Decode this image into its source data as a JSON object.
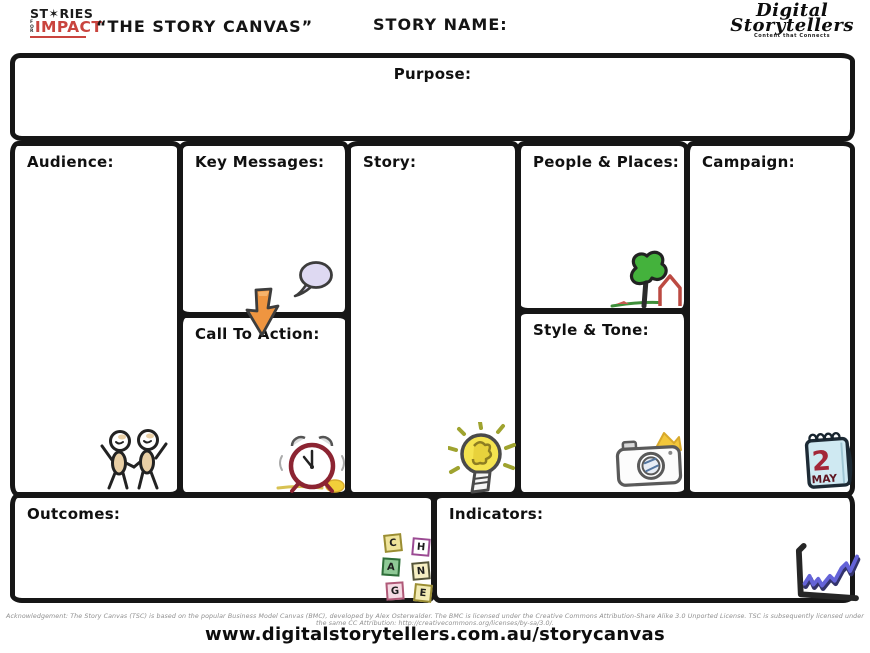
{
  "header": {
    "logo_stories": {
      "line1": "ST✶RIES",
      "for_text": "FOR",
      "line2": "IMPACT"
    },
    "canvas_title": "“THE STORY CANVAS”",
    "story_name_label": "STORY NAME:",
    "logo_digital": {
      "line1": "Digital",
      "line2": "Storytellers",
      "tagline": "Content that Connects"
    }
  },
  "sections": {
    "purpose": {
      "label": "Purpose:"
    },
    "audience": {
      "label": "Audience:"
    },
    "key_messages": {
      "label": "Key Messages:"
    },
    "call_to_action": {
      "label": "Call To Action:"
    },
    "story": {
      "label": "Story:"
    },
    "people_places": {
      "label": "People & Places:"
    },
    "style_tone": {
      "label": "Style & Tone:"
    },
    "campaign": {
      "label": "Campaign:"
    },
    "outcomes": {
      "label": "Outcomes:"
    },
    "indicators": {
      "label": "Indicators:"
    }
  },
  "icons": {
    "names": [
      "people-icon",
      "speech-bubble-icon",
      "down-arrow-icon",
      "tree-house-icon",
      "alarm-clock-icon",
      "lightbulb-icon",
      "camera-icon",
      "calendar-icon",
      "change-blocks-icon",
      "line-graph-icon"
    ],
    "calendar": {
      "day": "2",
      "month": "MAY"
    },
    "change_blocks": [
      "C",
      "H",
      "A",
      "N",
      "G",
      "E"
    ]
  },
  "footer": {
    "acknowledgement": "Acknowledgement: The Story Canvas (TSC) is based on the popular Business Model Canvas (BMC), developed by Alex Osterwalder. The BMC is licensed under the Creative Commons Attribution-Share Alike 3.0 Unported License. TSC is subsequently licensed under the same CC Attribution: http://creativecommons.org/licenses/by-sa/3.0/.",
    "url": "www.digitalstorytellers.com.au/storycanvas"
  },
  "colors": {
    "border_black": "#161616",
    "impact_red": "#c9443e",
    "arrow_orange": "#ef9540",
    "bubble_lavender": "#ded9f2",
    "bulb_yellow": "#f4e34f",
    "tree_green": "#44b23c",
    "house_red": "#bc4a42",
    "clock_maroon": "#8c2432",
    "calendar_blue": "#cfe9f2",
    "calendar_day_red": "#a32638",
    "graph_blue": "#6463d8"
  }
}
